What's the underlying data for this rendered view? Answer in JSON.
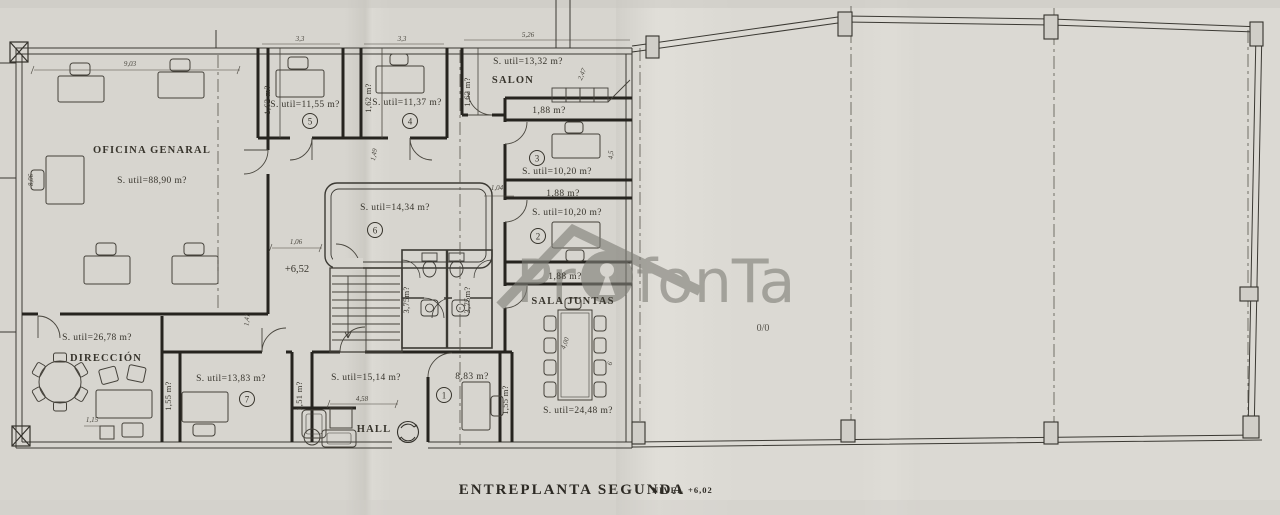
{
  "watermark": {
    "part1": "Pr",
    "part2": "fonTa"
  },
  "footer": {
    "title": "ENTREPLANTA SEGUNDA",
    "level_label": "NIVEL",
    "level_value": "+6,02"
  },
  "open_area": {
    "note": "0/0"
  },
  "level_mark": "+6,52",
  "rooms": {
    "oficina": {
      "name": "OFICINA GENARAL",
      "area": "S. util=88,90 m?"
    },
    "room5": {
      "num": "5",
      "area": "S. util=11,55 m?",
      "dim": "1,62 m?"
    },
    "room4": {
      "num": "4",
      "area": "S. util=11,37 m?",
      "dim": "1,62 m?"
    },
    "salon": {
      "name": "SALON",
      "area": "S. util=13,32 m?",
      "dim": "1,62 m?"
    },
    "room3": {
      "num": "3",
      "area": "S. util=10,20 m?"
    },
    "room2": {
      "num": "2",
      "area": "S. util=10,20 m?"
    },
    "room6": {
      "num": "6",
      "area": "S. util=14,34 m?"
    },
    "room7": {
      "num": "7",
      "area": "S. util=13,83 m?",
      "dim_left": "1,55 m?",
      "dim_right": "1,51 m?"
    },
    "room1": {
      "num": "1",
      "area": "8,83 m?",
      "dim": "1,55 m?"
    },
    "hall": {
      "name": "HALL",
      "area": "S. util=15,14 m?"
    },
    "direccion": {
      "name": "DIRECCIÓN",
      "area": "S. util=26,78 m?"
    },
    "sala_juntas": {
      "name": "SALA JUNTAS",
      "area": "S. util=24,48 m?"
    }
  },
  "corridors": {
    "c1": "1,88 m?",
    "c2": "1,88 m?",
    "c3": "1,88 m?"
  },
  "baths": {
    "left": "3,75m?",
    "right": "3,75m?"
  },
  "dimensions": {
    "d903": "9,03",
    "d33a": "3,3",
    "d33b": "3,3",
    "d526": "5,26",
    "d247": "2,47",
    "d806": "8,06",
    "d106": "1,06",
    "d149": "1,49",
    "d104": "1,04",
    "d141": "1,41",
    "d45": "4,5",
    "d400": "4,00",
    "d6": "6",
    "d458": "4,58",
    "d115": "1,15"
  },
  "colors": {
    "paper": "#d7d5cf",
    "line": "#3b3933",
    "watermark": "#807f78"
  }
}
